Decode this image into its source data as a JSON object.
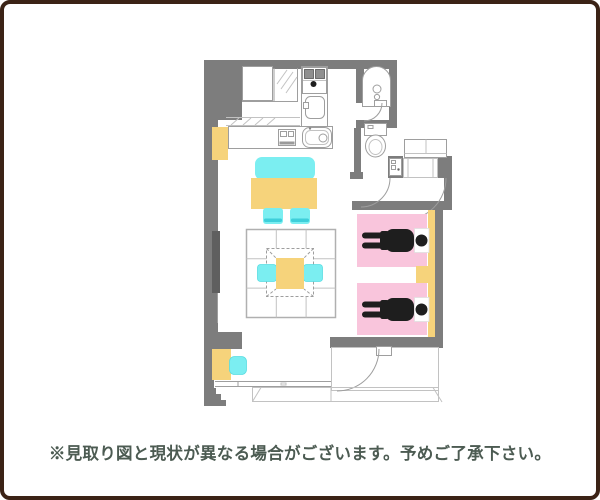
{
  "disclaimer": "※見取り図と現状が異なる場合がございます。予めご了承下さい。",
  "colors": {
    "background": "#ffffff",
    "frame_border": "#3b2316",
    "wall": "#7d7d7d",
    "wall_dark": "#5f5f5f",
    "line": "#9e9e9e",
    "line_light": "#c2c2c2",
    "furniture_yellow": "#f6d37b",
    "furniture_cyan": "#7beef1",
    "cyan_dark": "#3ecfda",
    "bed_pink": "#f9c5dc",
    "figure_black": "#1e1e1e",
    "text": "#4c5b52"
  },
  "floor_plan": {
    "type": "room-floor-plan",
    "fixtures": [
      "stove-icon",
      "kitchen-sink-icon",
      "counter-grill-icon",
      "counter-sink-icon",
      "bathtub-icon",
      "toilet-icon",
      "washing-machine-icon",
      "entrance-door-arc",
      "closet",
      "bed",
      "sleeping-person-icon",
      "pillow",
      "nightstand",
      "dining-bench",
      "dining-table",
      "dining-chair",
      "rug",
      "kotatsu-table",
      "floor-cushion",
      "tv-board",
      "desk",
      "desk-chair",
      "cabinet",
      "window",
      "balcony",
      "balcony-door-arc"
    ]
  }
}
